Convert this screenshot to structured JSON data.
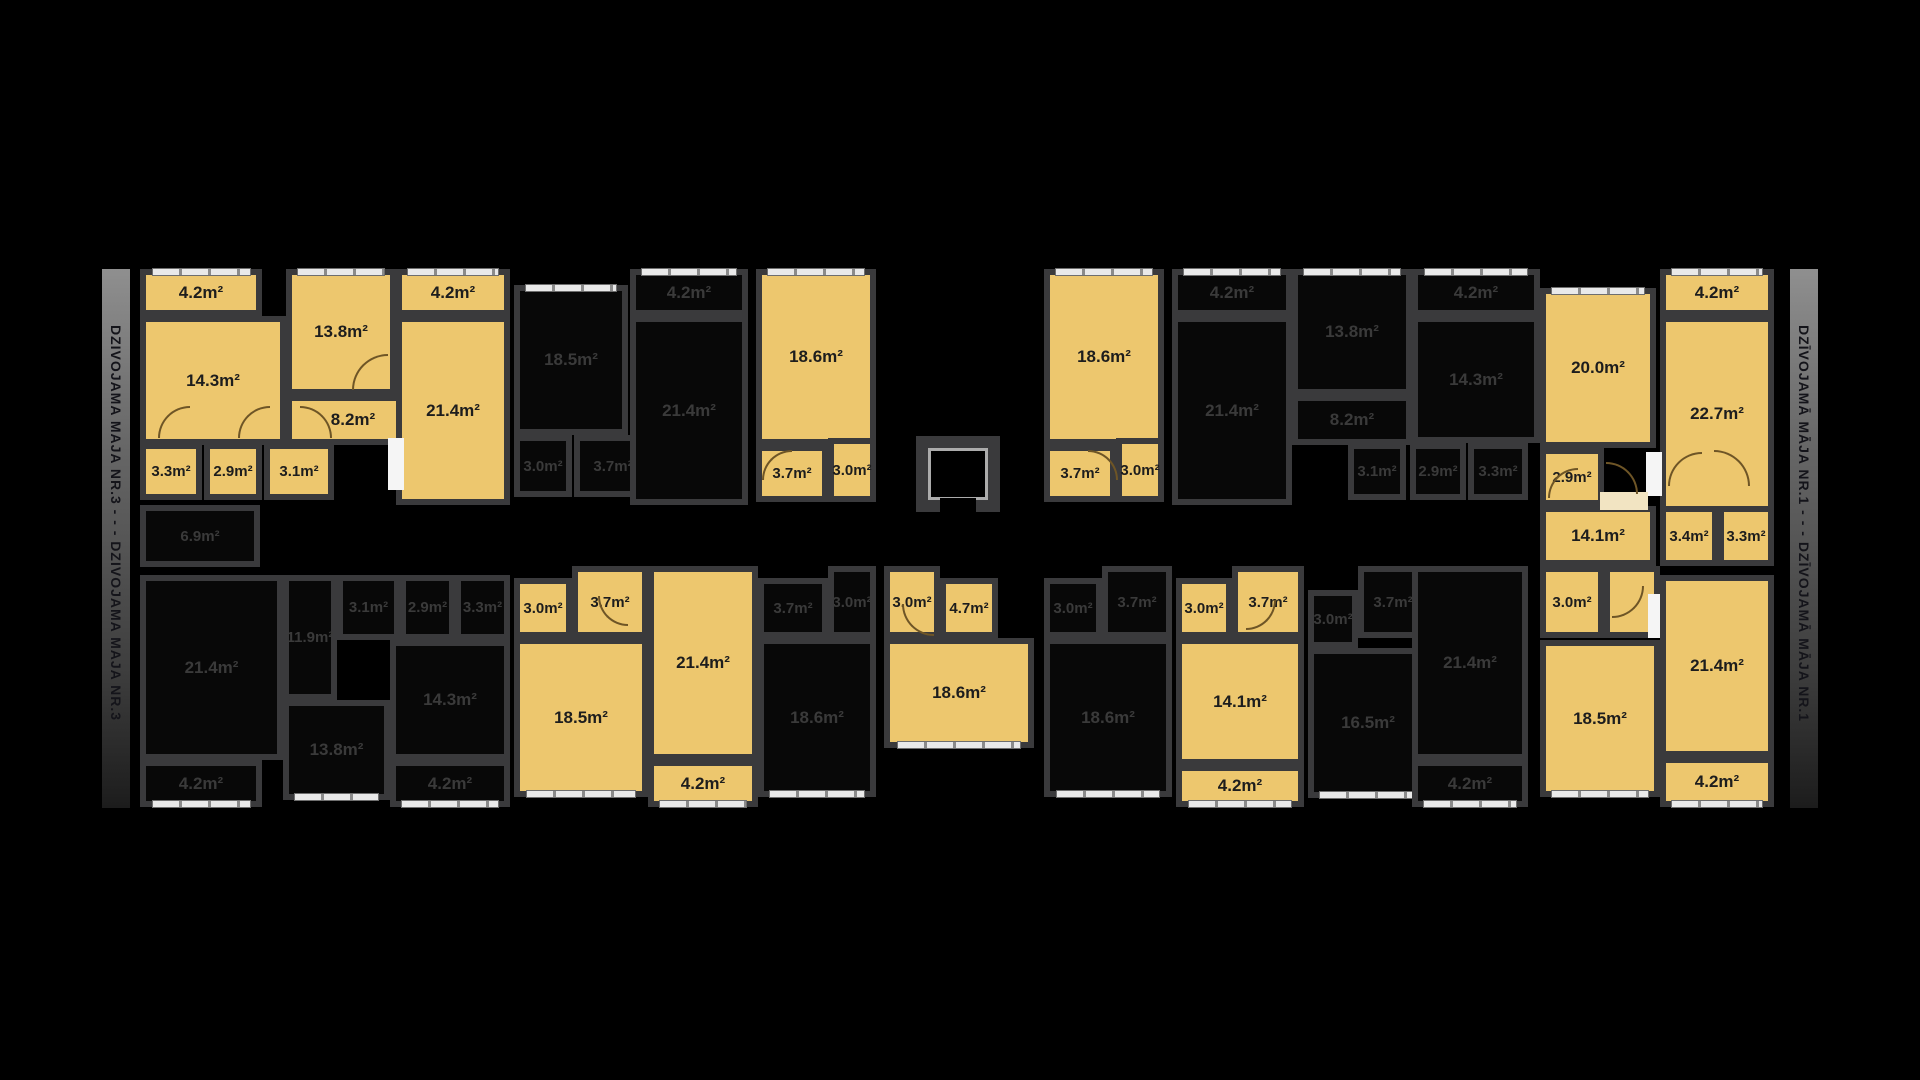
{
  "palette": {
    "yellow": "#edc76e",
    "dark_room": "#080808",
    "wall": "#3a3a3c",
    "window": "#e9e9e9",
    "label_yellow": "#1d1d1d",
    "label_dark": "#3a3a3a"
  },
  "bars": {
    "left": {
      "text": "DZIVOJAMA MAJA NR.3 - - - DZIVOJAMA MAJA NR.3"
    },
    "right": {
      "text": "DZĪVOJAMĀ MĀJA NR.1 - - - DZĪVOJAMĀ MĀJA NR.1"
    }
  },
  "rooms": [
    {
      "n": "a-balcony-1",
      "t": "4.2m²",
      "x": 140,
      "y": 269,
      "w": 122,
      "h": 47,
      "c": "yellow",
      "win": "top"
    },
    {
      "n": "a-room-14-3",
      "t": "14.3m²",
      "x": 140,
      "y": 316,
      "w": 146,
      "h": 129,
      "c": "yellow"
    },
    {
      "n": "a-room-13-8",
      "t": "13.8m²",
      "x": 286,
      "y": 269,
      "w": 110,
      "h": 126,
      "c": "yellow",
      "win": "top"
    },
    {
      "n": "a-room-8-2",
      "t": "8.2m²",
      "x": 286,
      "y": 395,
      "w": 134,
      "h": 50,
      "c": "yellow"
    },
    {
      "n": "a-balcony-2",
      "t": "4.2m²",
      "x": 396,
      "y": 269,
      "w": 114,
      "h": 47,
      "c": "yellow",
      "win": "top"
    },
    {
      "n": "a-room-21-4",
      "t": "21.4m²",
      "x": 396,
      "y": 316,
      "w": 114,
      "h": 189,
      "c": "yellow"
    },
    {
      "n": "a-room-3-3",
      "t": "3.3m²",
      "x": 140,
      "y": 443,
      "w": 62,
      "h": 57,
      "c": "yellow",
      "s": 1
    },
    {
      "n": "a-room-2-9",
      "t": "2.9m²",
      "x": 204,
      "y": 443,
      "w": 58,
      "h": 57,
      "c": "yellow",
      "s": 1
    },
    {
      "n": "a-room-3-1",
      "t": "3.1m²",
      "x": 264,
      "y": 443,
      "w": 70,
      "h": 57,
      "c": "yellow",
      "s": 1
    },
    {
      "n": "b-room-18-5",
      "t": "18.5m²",
      "x": 514,
      "y": 285,
      "w": 114,
      "h": 150,
      "c": "dark",
      "win": "top"
    },
    {
      "n": "b-room-3-0",
      "t": "3.0m²",
      "x": 514,
      "y": 435,
      "w": 58,
      "h": 62,
      "c": "dark",
      "s": 1
    },
    {
      "n": "b-room-3-7",
      "t": "3.7m²",
      "x": 574,
      "y": 435,
      "w": 78,
      "h": 62,
      "c": "dark",
      "s": 1
    },
    {
      "n": "b-balcony",
      "t": "4.2m²",
      "x": 630,
      "y": 269,
      "w": 118,
      "h": 47,
      "c": "dark",
      "win": "top"
    },
    {
      "n": "b-room-21-4",
      "t": "21.4m²",
      "x": 630,
      "y": 316,
      "w": 118,
      "h": 189,
      "c": "dark"
    },
    {
      "n": "c-room-18-6",
      "t": "18.6m²",
      "x": 756,
      "y": 269,
      "w": 120,
      "h": 176,
      "c": "yellow",
      "win": "top"
    },
    {
      "n": "c-room-3-7",
      "t": "3.7m²",
      "x": 756,
      "y": 445,
      "w": 72,
      "h": 57,
      "c": "yellow",
      "s": 1
    },
    {
      "n": "c-room-3-0",
      "t": "3.0m²",
      "x": 828,
      "y": 438,
      "w": 48,
      "h": 64,
      "c": "yellow",
      "s": 1
    },
    {
      "n": "c2-room-18-6",
      "t": "18.6m²",
      "x": 1044,
      "y": 269,
      "w": 120,
      "h": 176,
      "c": "yellow",
      "win": "top"
    },
    {
      "n": "c2-room-3-7",
      "t": "3.7m²",
      "x": 1044,
      "y": 445,
      "w": 72,
      "h": 57,
      "c": "yellow",
      "s": 1
    },
    {
      "n": "c2-room-3-0",
      "t": "3.0m²",
      "x": 1116,
      "y": 438,
      "w": 48,
      "h": 64,
      "c": "yellow",
      "s": 1
    },
    {
      "n": "a2-balcony-1",
      "t": "4.2m²",
      "x": 1172,
      "y": 269,
      "w": 120,
      "h": 47,
      "c": "dark",
      "win": "top"
    },
    {
      "n": "a2-room-21-4",
      "t": "21.4m²",
      "x": 1172,
      "y": 316,
      "w": 120,
      "h": 189,
      "c": "dark"
    },
    {
      "n": "a2-room-13-8",
      "t": "13.8m²",
      "x": 1292,
      "y": 269,
      "w": 120,
      "h": 126,
      "c": "dark",
      "win": "top"
    },
    {
      "n": "a2-room-8-2",
      "t": "8.2m²",
      "x": 1292,
      "y": 395,
      "w": 120,
      "h": 50,
      "c": "dark"
    },
    {
      "n": "a2-room-3-1",
      "t": "3.1m²",
      "x": 1348,
      "y": 443,
      "w": 58,
      "h": 57,
      "c": "dark",
      "s": 1
    },
    {
      "n": "a2-room-2-9",
      "t": "2.9m²",
      "x": 1410,
      "y": 443,
      "w": 56,
      "h": 57,
      "c": "dark",
      "s": 1
    },
    {
      "n": "a2-room-3-3",
      "t": "3.3m²",
      "x": 1468,
      "y": 443,
      "w": 60,
      "h": 57,
      "c": "dark",
      "s": 1
    },
    {
      "n": "a2-room-14-3",
      "t": "14.3m²",
      "x": 1412,
      "y": 316,
      "w": 128,
      "h": 127,
      "c": "dark"
    },
    {
      "n": "a2-balcony-2",
      "t": "4.2m²",
      "x": 1412,
      "y": 269,
      "w": 128,
      "h": 47,
      "c": "dark",
      "win": "top"
    },
    {
      "n": "e-room-20-0",
      "t": "20.0m²",
      "x": 1540,
      "y": 288,
      "w": 116,
      "h": 160,
      "c": "yellow",
      "win": "top"
    },
    {
      "n": "e-balcony-1",
      "t": "4.2m²",
      "x": 1660,
      "y": 269,
      "w": 114,
      "h": 47,
      "c": "yellow",
      "win": "top"
    },
    {
      "n": "e-room-22-7",
      "t": "22.7m²",
      "x": 1660,
      "y": 316,
      "w": 114,
      "h": 196,
      "c": "yellow"
    },
    {
      "n": "e-room-2-9",
      "t": "2.9m²",
      "x": 1540,
      "y": 448,
      "w": 64,
      "h": 58,
      "c": "yellow",
      "s": 1
    },
    {
      "n": "e-room-14-1",
      "t": "14.1m²",
      "x": 1540,
      "y": 506,
      "w": 116,
      "h": 60,
      "c": "yellow"
    },
    {
      "n": "e-room-3-4",
      "t": "3.4m²",
      "x": 1660,
      "y": 506,
      "w": 58,
      "h": 60,
      "c": "yellow",
      "s": 1
    },
    {
      "n": "e-room-3-3",
      "t": "3.3m²",
      "x": 1718,
      "y": 506,
      "w": 56,
      "h": 60,
      "c": "yellow",
      "s": 1
    },
    {
      "n": "corridor-6-9",
      "t": "6.9m²",
      "x": 140,
      "y": 505,
      "w": 120,
      "h": 62,
      "c": "dark",
      "s": 1
    },
    {
      "n": "d1-room-21-4",
      "t": "21.4m²",
      "x": 140,
      "y": 575,
      "w": 143,
      "h": 185,
      "c": "dark"
    },
    {
      "n": "d1-balcony-1",
      "t": "4.2m²",
      "x": 140,
      "y": 760,
      "w": 122,
      "h": 47,
      "c": "dark",
      "win": "bottom"
    },
    {
      "n": "d1-room-11-9",
      "t": "11.9m²",
      "x": 283,
      "y": 575,
      "w": 54,
      "h": 125,
      "c": "dark",
      "s": 1
    },
    {
      "n": "d1-room-3-1",
      "t": "3.1m²",
      "x": 337,
      "y": 575,
      "w": 63,
      "h": 65,
      "c": "dark",
      "s": 1
    },
    {
      "n": "d1-room-2-9",
      "t": "2.9m²",
      "x": 400,
      "y": 575,
      "w": 55,
      "h": 65,
      "c": "dark",
      "s": 1
    },
    {
      "n": "d1-room-3-3",
      "t": "3.3m²",
      "x": 455,
      "y": 575,
      "w": 55,
      "h": 65,
      "c": "dark",
      "s": 1
    },
    {
      "n": "d1-room-13-8",
      "t": "13.8m²",
      "x": 283,
      "y": 700,
      "w": 107,
      "h": 100,
      "c": "dark",
      "win": "bottom"
    },
    {
      "n": "d1-room-14-3",
      "t": "14.3m²",
      "x": 390,
      "y": 640,
      "w": 120,
      "h": 120,
      "c": "dark"
    },
    {
      "n": "d1-balcony-2",
      "t": "4.2m²",
      "x": 390,
      "y": 760,
      "w": 120,
      "h": 47,
      "c": "dark",
      "win": "bottom"
    },
    {
      "n": "y2-room-3-0",
      "t": "3.0m²",
      "x": 514,
      "y": 578,
      "w": 58,
      "h": 60,
      "c": "yellow",
      "s": 1
    },
    {
      "n": "y2-room-3-7",
      "t": "3.7m²",
      "x": 572,
      "y": 566,
      "w": 76,
      "h": 72,
      "c": "yellow",
      "s": 1
    },
    {
      "n": "y2-room-18-5",
      "t": "18.5m²",
      "x": 514,
      "y": 638,
      "w": 134,
      "h": 159,
      "c": "yellow",
      "win": "bottom"
    },
    {
      "n": "y2-room-21-4",
      "t": "21.4m²",
      "x": 648,
      "y": 566,
      "w": 110,
      "h": 194,
      "c": "yellow"
    },
    {
      "n": "y2-balcony",
      "t": "4.2m²",
      "x": 648,
      "y": 760,
      "w": 110,
      "h": 47,
      "c": "yellow",
      "win": "bottom"
    },
    {
      "n": "d3-room-3-7",
      "t": "3.7m²",
      "x": 758,
      "y": 578,
      "w": 70,
      "h": 60,
      "c": "dark",
      "s": 1
    },
    {
      "n": "d3-room-3-0",
      "t": "3.0m²",
      "x": 828,
      "y": 566,
      "w": 48,
      "h": 72,
      "c": "dark",
      "s": 1
    },
    {
      "n": "d3-room-18-6",
      "t": "18.6m²",
      "x": 758,
      "y": 638,
      "w": 118,
      "h": 159,
      "c": "dark",
      "win": "bottom"
    },
    {
      "n": "y4-room-3-0",
      "t": "3.0m²",
      "x": 884,
      "y": 566,
      "w": 56,
      "h": 72,
      "c": "yellow",
      "s": 1
    },
    {
      "n": "y4-room-4-7",
      "t": "4.7m²",
      "x": 940,
      "y": 578,
      "w": 58,
      "h": 60,
      "c": "yellow",
      "s": 1
    },
    {
      "n": "y4-room-18-6",
      "t": "18.6m²",
      "x": 884,
      "y": 638,
      "w": 150,
      "h": 110,
      "c": "yellow",
      "win": "bottom"
    },
    {
      "n": "d5-room-3-0",
      "t": "3.0m²",
      "x": 1044,
      "y": 578,
      "w": 58,
      "h": 60,
      "c": "dark",
      "s": 1
    },
    {
      "n": "d5-room-3-7",
      "t": "3.7m²",
      "x": 1102,
      "y": 566,
      "w": 70,
      "h": 72,
      "c": "dark",
      "s": 1
    },
    {
      "n": "d5-room-18-6",
      "t": "18.6m²",
      "x": 1044,
      "y": 638,
      "w": 128,
      "h": 159,
      "c": "dark",
      "win": "bottom"
    },
    {
      "n": "y6-room-3-0",
      "t": "3.0m²",
      "x": 1176,
      "y": 578,
      "w": 56,
      "h": 60,
      "c": "yellow",
      "s": 1
    },
    {
      "n": "y6-room-3-7",
      "t": "3.7m²",
      "x": 1232,
      "y": 566,
      "w": 72,
      "h": 72,
      "c": "yellow",
      "s": 1
    },
    {
      "n": "y6-room-14-1",
      "t": "14.1m²",
      "x": 1176,
      "y": 638,
      "w": 128,
      "h": 127,
      "c": "yellow"
    },
    {
      "n": "y6-balcony",
      "t": "4.2m²",
      "x": 1176,
      "y": 765,
      "w": 128,
      "h": 42,
      "c": "yellow",
      "win": "bottom"
    },
    {
      "n": "d7-room-3-0",
      "t": "3.0m²",
      "x": 1308,
      "y": 590,
      "w": 50,
      "h": 58,
      "c": "dark",
      "s": 1
    },
    {
      "n": "d7-room-3-7",
      "t": "3.7m²",
      "x": 1358,
      "y": 566,
      "w": 70,
      "h": 72,
      "c": "dark",
      "s": 1
    },
    {
      "n": "d7-room-16-5",
      "t": "16.5m²",
      "x": 1308,
      "y": 648,
      "w": 120,
      "h": 150,
      "c": "dark",
      "win": "bottom"
    },
    {
      "n": "d7-room-21-4",
      "t": "21.4m²",
      "x": 1412,
      "y": 566,
      "w": 116,
      "h": 194,
      "c": "dark"
    },
    {
      "n": "d7-balcony",
      "t": "4.2m²",
      "x": 1412,
      "y": 760,
      "w": 116,
      "h": 47,
      "c": "dark",
      "win": "bottom"
    },
    {
      "n": "e-room-3-0",
      "t": "3.0m²",
      "x": 1540,
      "y": 566,
      "w": 64,
      "h": 72,
      "c": "yellow",
      "s": 1
    },
    {
      "n": "e-entry",
      "t": "",
      "x": 1604,
      "y": 566,
      "w": 56,
      "h": 72,
      "c": "yellow"
    },
    {
      "n": "e-room-18-5",
      "t": "18.5m²",
      "x": 1540,
      "y": 640,
      "w": 120,
      "h": 157,
      "c": "yellow",
      "win": "bottom"
    },
    {
      "n": "e-room-21-4",
      "t": "21.4m²",
      "x": 1660,
      "y": 575,
      "w": 114,
      "h": 182,
      "c": "yellow"
    },
    {
      "n": "e-balcony-2",
      "t": "4.2m²",
      "x": 1660,
      "y": 757,
      "w": 114,
      "h": 50,
      "c": "yellow",
      "win": "bottom"
    }
  ],
  "elevator": {
    "outer": {
      "x": 916,
      "y": 436,
      "w": 84,
      "h": 76
    },
    "inner": {
      "x": 928,
      "y": 448,
      "w": 60,
      "h": 52
    },
    "opening": {
      "x": 940,
      "y": 498,
      "w": 36,
      "h": 16
    }
  },
  "passages": [
    {
      "x": 388,
      "y": 438,
      "w": 16,
      "h": 52,
      "c": "#f5f5f5"
    },
    {
      "x": 1646,
      "y": 452,
      "w": 16,
      "h": 44,
      "c": "#f5f5f5"
    },
    {
      "x": 1600,
      "y": 492,
      "w": 48,
      "h": 18,
      "c": "#f2e4c2"
    },
    {
      "x": 1648,
      "y": 594,
      "w": 12,
      "h": 44,
      "c": "#f5f5f5"
    }
  ],
  "doors": [
    {
      "x": 158,
      "y": 406,
      "s": 32,
      "q": "tl"
    },
    {
      "x": 238,
      "y": 406,
      "s": 32,
      "q": "tl"
    },
    {
      "x": 300,
      "y": 406,
      "s": 32,
      "q": "tr"
    },
    {
      "x": 352,
      "y": 354,
      "s": 36,
      "q": "tl"
    },
    {
      "x": 762,
      "y": 450,
      "s": 30,
      "q": "tl"
    },
    {
      "x": 1088,
      "y": 450,
      "s": 30,
      "q": "tr"
    },
    {
      "x": 902,
      "y": 604,
      "s": 32,
      "q": "bl"
    },
    {
      "x": 598,
      "y": 596,
      "s": 30,
      "q": "bl"
    },
    {
      "x": 1246,
      "y": 600,
      "s": 30,
      "q": "br"
    },
    {
      "x": 1548,
      "y": 468,
      "s": 30,
      "q": "tl"
    },
    {
      "x": 1606,
      "y": 462,
      "s": 32,
      "q": "tr"
    },
    {
      "x": 1668,
      "y": 452,
      "s": 34,
      "q": "tl"
    },
    {
      "x": 1714,
      "y": 450,
      "s": 36,
      "q": "tr"
    },
    {
      "x": 1612,
      "y": 586,
      "s": 32,
      "q": "br"
    }
  ]
}
